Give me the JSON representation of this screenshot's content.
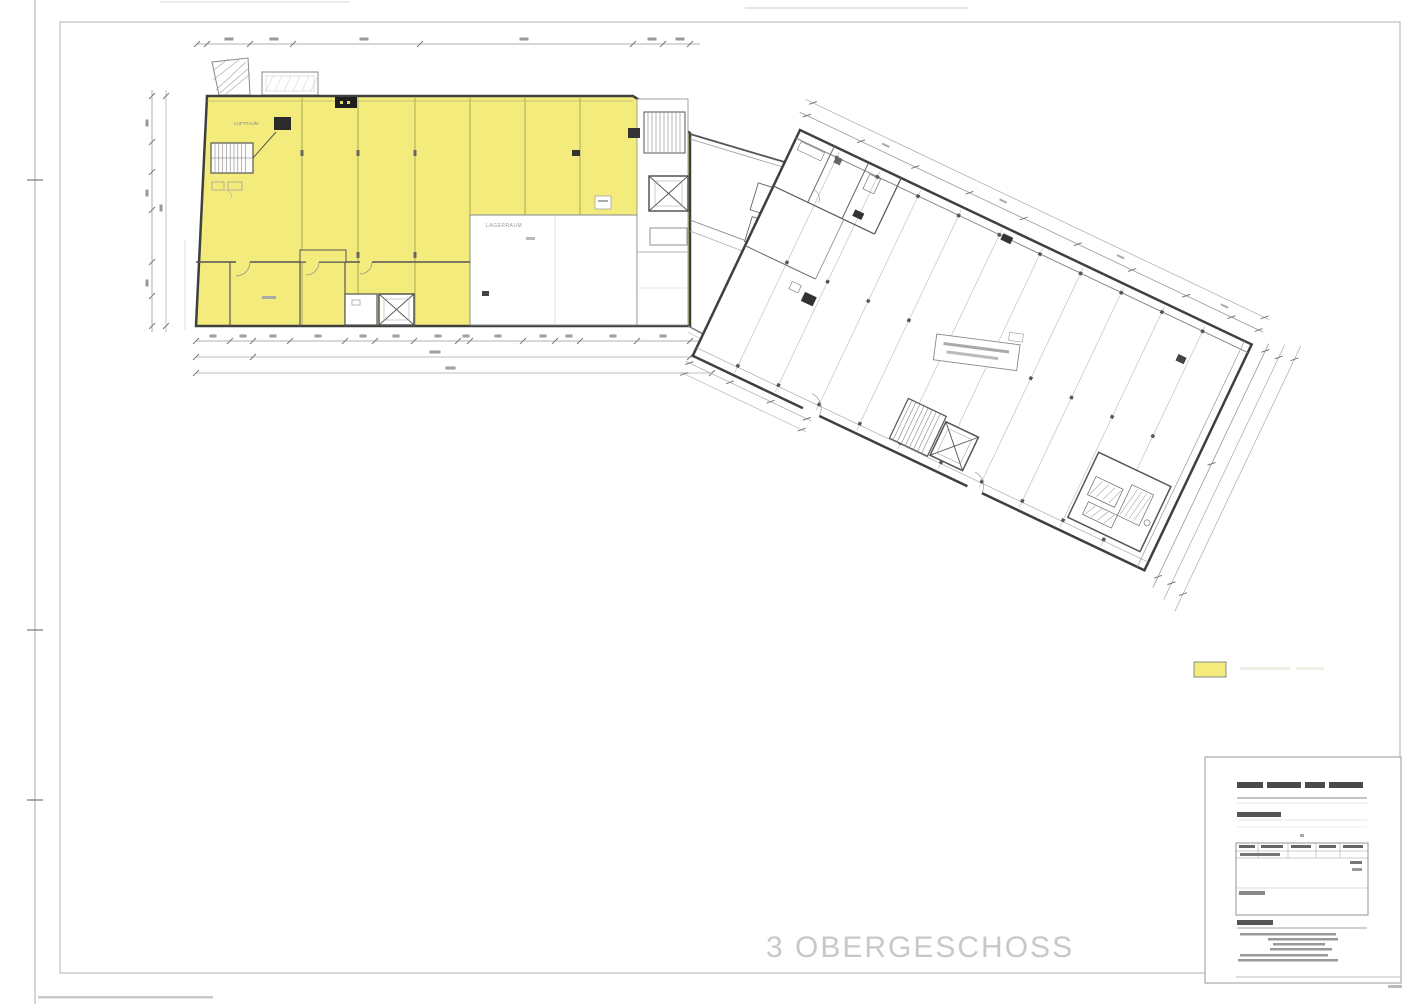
{
  "plan": {
    "floor_title": "3 OBERGESCHOSS",
    "labels": {
      "storage_room": "LAGERRAUM",
      "void": "LUFTRAUM"
    },
    "colors": {
      "highlight": "#f3ec7d",
      "wall": "#3f3f3f",
      "title_gray": "#c8c8c8"
    }
  },
  "legend": {
    "swatch_color": "#f3ec7d"
  }
}
